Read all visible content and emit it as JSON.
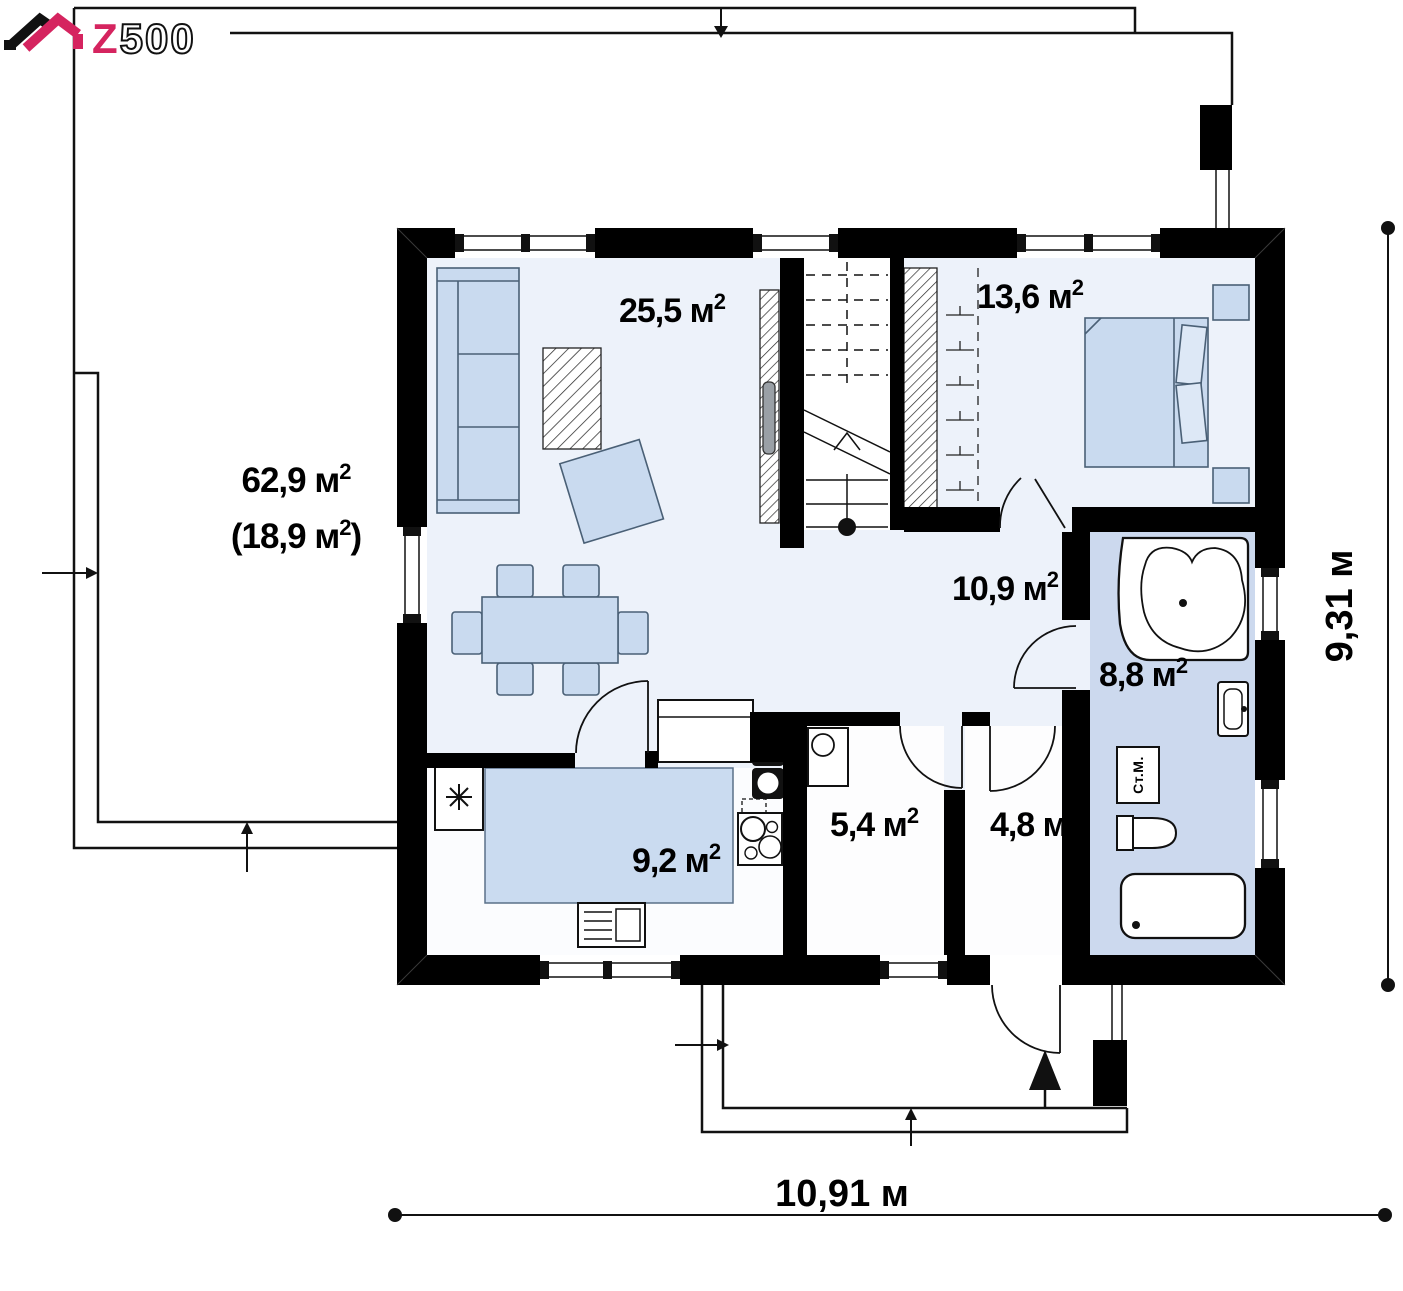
{
  "logo": {
    "z": "Z",
    "rest": "500"
  },
  "areas": {
    "living": {
      "text": "25,5 м",
      "sup": "2"
    },
    "bedroom": {
      "text": "13,6 м",
      "sup": "2"
    },
    "terrace_total": {
      "text": "62,9 м",
      "sup": "2"
    },
    "terrace_covered": {
      "text": "(18,9 м",
      "sup": "2",
      "suffix": ")"
    },
    "hall": {
      "text": "10,9 м",
      "sup": "2"
    },
    "bathroom": {
      "text": "8,8 м",
      "sup": "2"
    },
    "kitchen": {
      "text": "9,2 м",
      "sup": "2"
    },
    "utility": {
      "text": "5,4 м",
      "sup": "2"
    },
    "entry": {
      "text": "4,8 м",
      "sup": "2"
    }
  },
  "dimensions": {
    "width": "10,91 м",
    "height": "9,31 м"
  },
  "appliances": {
    "washing_machine": "Ст.М."
  },
  "colors": {
    "wall": "#000000",
    "floor": "#edf2fa",
    "kitchen_zone": "#cadbf0",
    "bathroom_floor": "#ccd9ee",
    "furniture": "#c9daef",
    "fixture": "#ffffff",
    "logo_pink": "#d5245f"
  }
}
